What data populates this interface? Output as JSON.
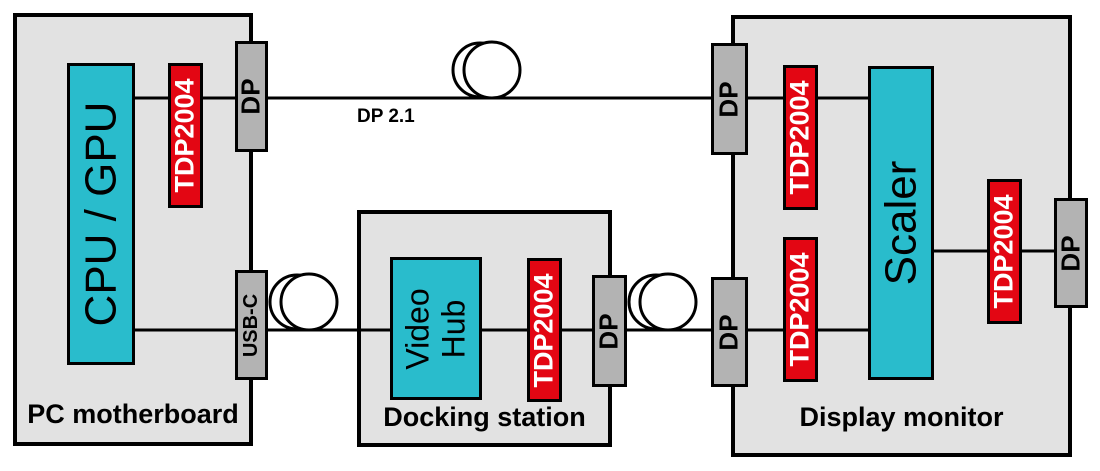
{
  "groups": {
    "pc": {
      "label": "PC motherboard"
    },
    "dock": {
      "label": "Docking station"
    },
    "display": {
      "label": "Display monitor"
    }
  },
  "components": {
    "cpu_gpu": "CPU / GPU",
    "video_hub_line1": "Video",
    "video_hub_line2": "Hub",
    "scaler": "Scaler",
    "retimer": "TDP2004",
    "dp_port": "DP",
    "usbc_port": "USB-C"
  },
  "links": {
    "top_label": "DP 2.1"
  },
  "icons": {
    "cable_coil": "cable-coil-icon"
  },
  "colors": {
    "chip_cyan": "#29bccc",
    "retimer_red": "#e30613",
    "connector_gray": "#b3b3b3",
    "enclosure_gray": "#e2e2e2",
    "line_black": "#000000"
  }
}
